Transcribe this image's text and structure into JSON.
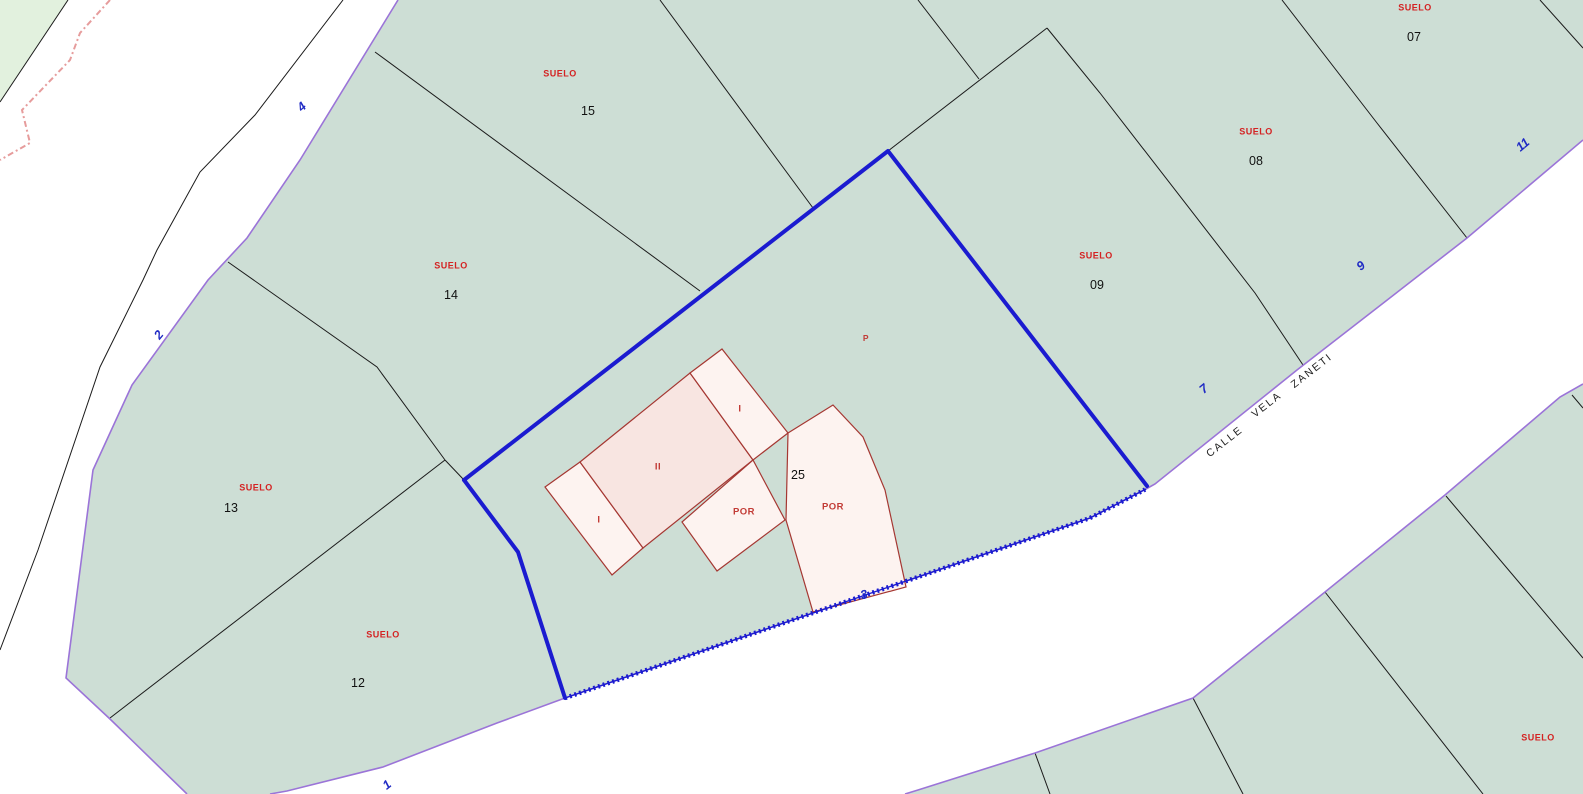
{
  "title": "Cadastral parcel map",
  "street": {
    "name_words": [
      "CALLE",
      "VELA",
      "ZANETI"
    ]
  },
  "street_numbers": [
    {
      "value": "4"
    },
    {
      "value": "2"
    },
    {
      "value": "1"
    },
    {
      "value": "3"
    },
    {
      "value": "7"
    },
    {
      "value": "9"
    },
    {
      "value": "11"
    }
  ],
  "parcels": [
    {
      "land_use": "SUELO",
      "number": "15"
    },
    {
      "land_use": "SUELO",
      "number": "14"
    },
    {
      "land_use": "SUELO",
      "number": "13"
    },
    {
      "land_use": "SUELO",
      "number": "12"
    },
    {
      "land_use": "SUELO",
      "number": "09"
    },
    {
      "land_use": "SUELO",
      "number": "08"
    },
    {
      "land_use": "SUELO",
      "number": "07"
    },
    {
      "land_use": "SUELO",
      "number": ""
    }
  ],
  "partial_parcel_number": "12",
  "selected_parcel": {
    "address_number": "25",
    "building_labels": [
      {
        "value": "I"
      },
      {
        "value": "II"
      },
      {
        "value": "I"
      }
    ],
    "porch_labels": [
      {
        "value": "POR"
      },
      {
        "value": "POR"
      }
    ],
    "patio_label": "P"
  },
  "colors": {
    "street_fill": "#ffffff",
    "parcel_fill": "#cdded5",
    "green_fill": "#e2f1de",
    "street_edge": "#9b74d8",
    "selection_blue": "#1b1bd0",
    "building_fill": "#fdf3f0",
    "building_fill_dark": "#f8e5e1",
    "building_outline": "#a53732",
    "label_red": "#d42222",
    "number_blue": "#1f2ac4",
    "boundary_pink": "#e69c9c",
    "parcel_line": "#1a1a1a"
  }
}
